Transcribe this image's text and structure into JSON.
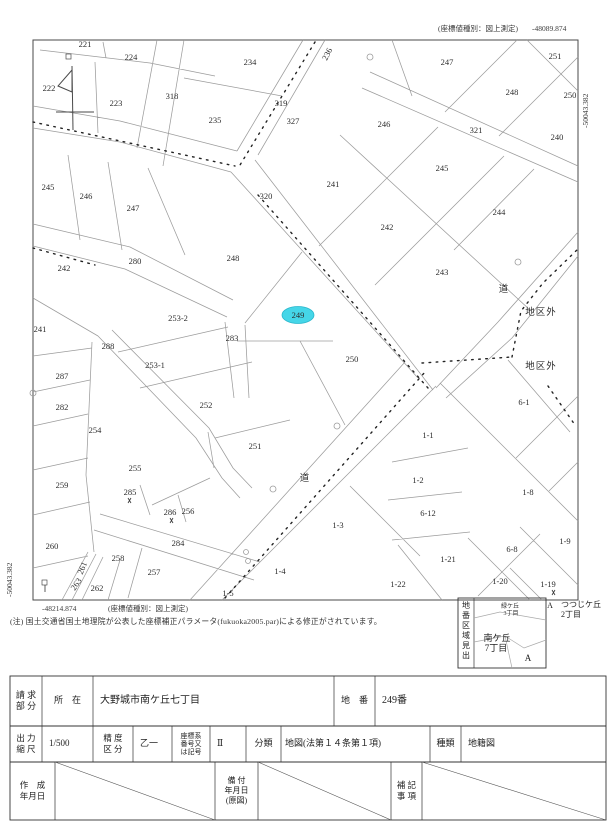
{
  "document_type": "地籍図 (cadastral map extract)",
  "coords": {
    "type_label": "(座標値種別：図上測定)",
    "top_right_x": "-48089.874",
    "right_edge_y": "-50043.382",
    "bottom_left_x": "-48214.874",
    "left_edge_y": "-50043.382"
  },
  "note": "(注) 国土交通省国土地理院が公表した座標補正パラメータ(fukuoka2005.par)による修正がされています。",
  "map": {
    "highlight_color": "#45d6e8",
    "highlighted_parcel": "249",
    "parcels": [
      {
        "id": "221",
        "x": 85,
        "y": 44
      },
      {
        "id": "224",
        "x": 131,
        "y": 57
      },
      {
        "id": "222",
        "x": 49,
        "y": 88
      },
      {
        "id": "223",
        "x": 116,
        "y": 103
      },
      {
        "id": "318",
        "x": 172,
        "y": 96
      },
      {
        "id": "234",
        "x": 250,
        "y": 62
      },
      {
        "id": "235",
        "x": 215,
        "y": 120
      },
      {
        "id": "319",
        "x": 281,
        "y": 103
      },
      {
        "id": "327",
        "x": 293,
        "y": 121
      },
      {
        "id": "236",
        "x": 327,
        "y": 54,
        "rot": -63
      },
      {
        "id": "247",
        "x": 447,
        "y": 62
      },
      {
        "id": "251",
        "x": 555,
        "y": 56
      },
      {
        "id": "248",
        "x": 512,
        "y": 92
      },
      {
        "id": "250",
        "x": 570,
        "y": 95
      },
      {
        "id": "321",
        "x": 476,
        "y": 130
      },
      {
        "id": "246",
        "x": 384,
        "y": 124
      },
      {
        "id": "240",
        "x": 557,
        "y": 137
      },
      {
        "id": "245",
        "x": 442,
        "y": 168
      },
      {
        "id": "241",
        "x": 333,
        "y": 184
      },
      {
        "id": "244",
        "x": 499,
        "y": 212
      },
      {
        "id": "242",
        "x": 387,
        "y": 227
      },
      {
        "id": "243",
        "x": 442,
        "y": 272
      },
      {
        "id": "245",
        "x": 48,
        "y": 187
      },
      {
        "id": "246",
        "x": 86,
        "y": 196
      },
      {
        "id": "247",
        "x": 133,
        "y": 208
      },
      {
        "id": "320",
        "x": 266,
        "y": 196
      },
      {
        "id": "242",
        "x": 64,
        "y": 268
      },
      {
        "id": "280",
        "x": 135,
        "y": 261
      },
      {
        "id": "248",
        "x": 233,
        "y": 258
      },
      {
        "id": "241",
        "x": 40,
        "y": 329
      },
      {
        "id": "253-2",
        "x": 178,
        "y": 318
      },
      {
        "id": "249",
        "x": 298,
        "y": 315,
        "highlight": true
      },
      {
        "id": "283",
        "x": 232,
        "y": 338
      },
      {
        "id": "288",
        "x": 108,
        "y": 346
      },
      {
        "id": "253-1",
        "x": 155,
        "y": 365
      },
      {
        "id": "287",
        "x": 62,
        "y": 376
      },
      {
        "id": "282",
        "x": 62,
        "y": 407
      },
      {
        "id": "252",
        "x": 206,
        "y": 405
      },
      {
        "id": "254",
        "x": 95,
        "y": 430
      },
      {
        "id": "251",
        "x": 255,
        "y": 446
      },
      {
        "id": "255",
        "x": 135,
        "y": 468
      },
      {
        "id": "259",
        "x": 62,
        "y": 485
      },
      {
        "id": "285",
        "x": 130,
        "y": 492
      },
      {
        "id": "286",
        "x": 170,
        "y": 512
      },
      {
        "id": "256",
        "x": 188,
        "y": 511
      },
      {
        "id": "250",
        "x": 352,
        "y": 359
      },
      {
        "id": "260",
        "x": 52,
        "y": 546
      },
      {
        "id": "284",
        "x": 178,
        "y": 543
      },
      {
        "id": "258",
        "x": 118,
        "y": 558
      },
      {
        "id": "261",
        "x": 82,
        "y": 568,
        "rot": -68
      },
      {
        "id": "257",
        "x": 154,
        "y": 572
      },
      {
        "id": "263",
        "x": 76,
        "y": 584,
        "rot": -55
      },
      {
        "id": "262",
        "x": 97,
        "y": 588
      },
      {
        "id": "1-4",
        "x": 280,
        "y": 571
      },
      {
        "id": "1-5",
        "x": 228,
        "y": 593
      },
      {
        "id": "6-1",
        "x": 524,
        "y": 402
      },
      {
        "id": "1-1",
        "x": 428,
        "y": 435
      },
      {
        "id": "1-2",
        "x": 418,
        "y": 480
      },
      {
        "id": "1-8",
        "x": 528,
        "y": 492
      },
      {
        "id": "6-12",
        "x": 428,
        "y": 513
      },
      {
        "id": "1-3",
        "x": 338,
        "y": 525
      },
      {
        "id": "1-9",
        "x": 565,
        "y": 541
      },
      {
        "id": "6-8",
        "x": 512,
        "y": 549
      },
      {
        "id": "1-21",
        "x": 448,
        "y": 559
      },
      {
        "id": "1-22",
        "x": 398,
        "y": 584
      },
      {
        "id": "1-20",
        "x": 500,
        "y": 581
      },
      {
        "id": "1-19",
        "x": 548,
        "y": 584
      }
    ],
    "area_labels": [
      {
        "text": "道",
        "x": 504,
        "y": 292
      },
      {
        "text": "道",
        "x": 305,
        "y": 481
      },
      {
        "text": "地区外",
        "x": 541,
        "y": 315
      },
      {
        "text": "地区外",
        "x": 541,
        "y": 369
      }
    ]
  },
  "index_box": {
    "title": "地番区域見出",
    "adjacent_top": [
      "緑ケ丘",
      "3丁目"
    ],
    "current": [
      "南ケ丘",
      "7丁目"
    ],
    "marker_inside": "A",
    "marker_outside": "A",
    "adjacent_right": [
      "つつじケ丘",
      "2丁目"
    ]
  },
  "table": {
    "row1": {
      "c1": [
        "請 求",
        "部 分"
      ],
      "c2": "所　在",
      "c3": "大野城市南ケ丘七丁目",
      "c4": "地　番",
      "c5": "249番"
    },
    "row2": {
      "c1": [
        "出 力",
        "縮 尺"
      ],
      "c2": "1/500",
      "c3": [
        "精 度",
        "区 分"
      ],
      "c4": "乙一",
      "c5": [
        "座標系",
        "番号又",
        "は記号"
      ],
      "c6": "Ⅱ",
      "c7": "分類",
      "c8": "地図(法第１４条第１項)",
      "c9": "種類",
      "c10": "地籍図"
    },
    "row3": {
      "c1": [
        "作　成",
        "年月日"
      ],
      "c2": [
        "備 付",
        "年月日",
        "(原図)"
      ],
      "c3": [
        "補 記",
        "事 項"
      ]
    }
  }
}
